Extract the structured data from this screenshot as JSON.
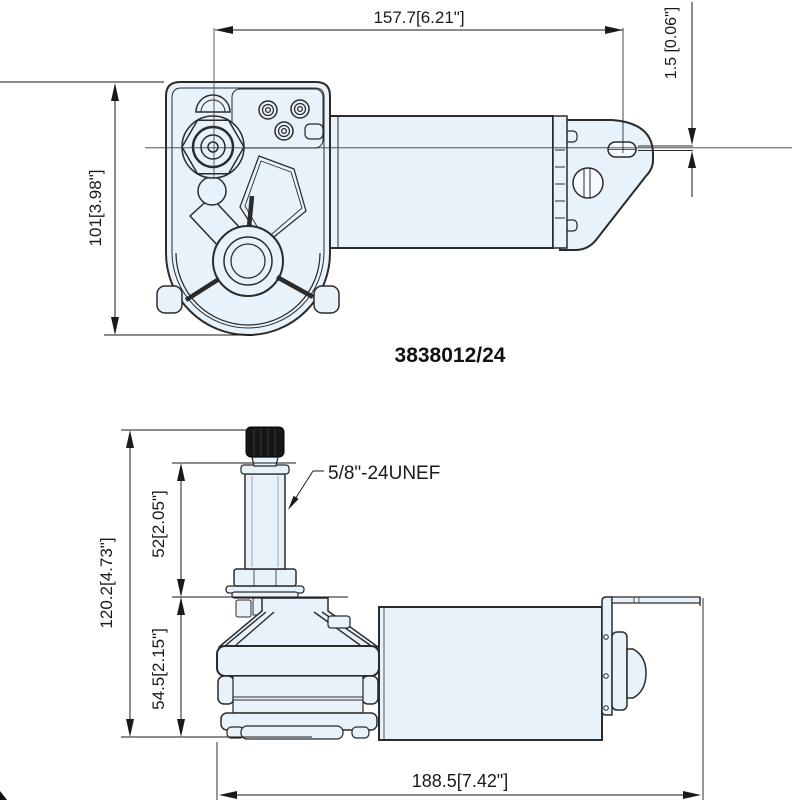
{
  "drawing": {
    "background": "#ffffff",
    "line_color": "#2b2b2b",
    "fill_color": "#e8f2fb",
    "part_number": "3838012/24",
    "top_view": {
      "dim_width": "157.7[6.21\"]",
      "dim_height": "101[3.98\"]",
      "dim_plate_thickness": "1.5 [0.06\"]"
    },
    "side_view": {
      "dim_total_height": "120.2[4.73\"]",
      "dim_shaft_height": "52[2.05\"]",
      "dim_body_height": "54.5[2.15\"]",
      "dim_total_length": "188.5[7.42\"]",
      "thread_label": "5/8\"-24UNEF"
    }
  }
}
